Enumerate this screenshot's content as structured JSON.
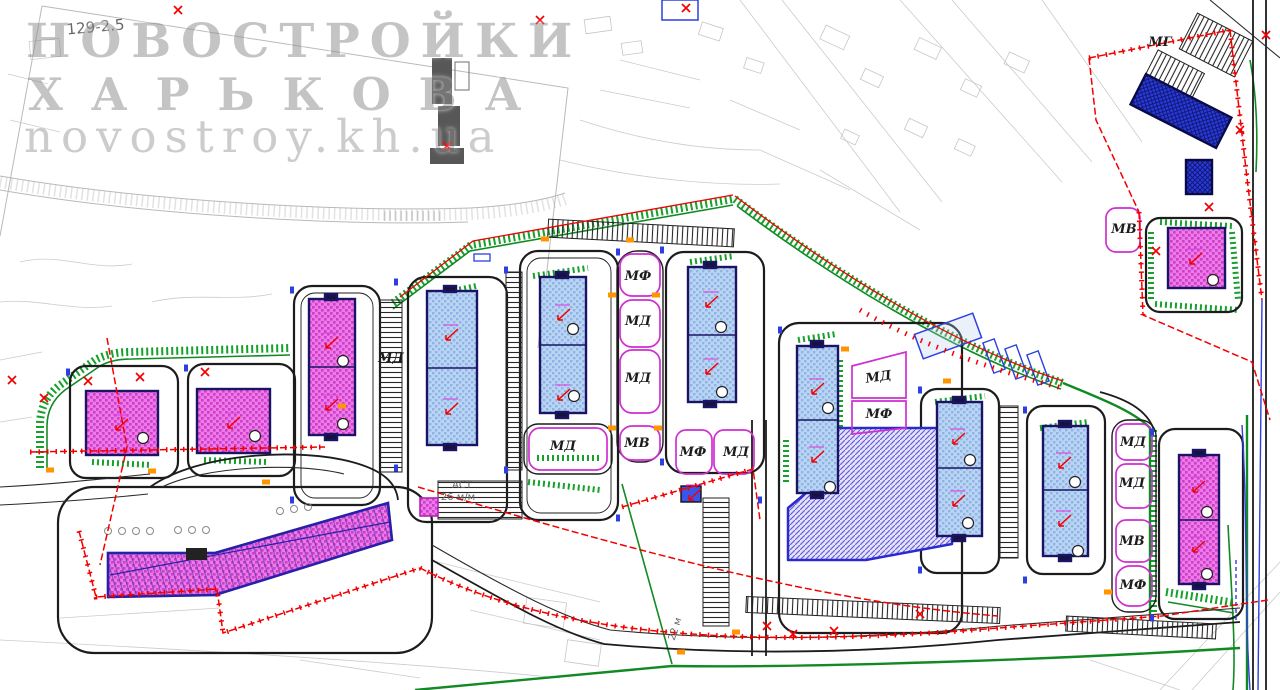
{
  "watermark": {
    "line1": "НОВОСТРОЙКИ",
    "line2": "ХАРЬКОВА",
    "line3": "novostroy.kh.ua"
  },
  "plan": {
    "zone_labels": [
      {
        "text": "МФ",
        "x": 638,
        "y": 280,
        "rotate": 0
      },
      {
        "text": "МД",
        "x": 638,
        "y": 325,
        "rotate": 0
      },
      {
        "text": "МД",
        "x": 638,
        "y": 382,
        "rotate": 0
      },
      {
        "text": "МВ",
        "x": 637,
        "y": 447,
        "rotate": 0
      },
      {
        "text": "МФ",
        "x": 693,
        "y": 456,
        "rotate": 0
      },
      {
        "text": "МД",
        "x": 736,
        "y": 456,
        "rotate": 0
      },
      {
        "text": "МД",
        "x": 391,
        "y": 362,
        "rotate": 0
      },
      {
        "text": "МД",
        "x": 563,
        "y": 450,
        "rotate": 0
      },
      {
        "text": "МД",
        "x": 879,
        "y": 381,
        "rotate": -8
      },
      {
        "text": "МФ",
        "x": 879,
        "y": 418,
        "rotate": 0
      },
      {
        "text": "МД",
        "x": 1133,
        "y": 446,
        "rotate": 0
      },
      {
        "text": "МД",
        "x": 1132,
        "y": 487,
        "rotate": 0
      },
      {
        "text": "МВ",
        "x": 1132,
        "y": 545,
        "rotate": 0
      },
      {
        "text": "МФ",
        "x": 1133,
        "y": 589,
        "rotate": 0
      },
      {
        "text": "МВ",
        "x": 1124,
        "y": 233,
        "rotate": 0
      },
      {
        "text": "МГ",
        "x": 1160,
        "y": 46,
        "rotate": 0
      }
    ],
    "notes": [
      {
        "text": "129-2.5",
        "x": 96,
        "y": 32,
        "rotate": -5,
        "size": 15
      },
      {
        "text": "АСТ",
        "x": 462,
        "y": 488,
        "rotate": 0,
        "size": 10
      },
      {
        "text": "26 м/м",
        "x": 458,
        "y": 500,
        "rotate": 0,
        "size": 10
      },
      {
        "text": "22 м",
        "x": 678,
        "y": 630,
        "rotate": -72,
        "size": 10
      }
    ]
  },
  "colors": {
    "magenta_building_fill": "#ec7ae8",
    "magenta_building_hatch": "#c437be",
    "blue_building_fill": "#b9d3f2",
    "blue_building_hatch": "#86abdc",
    "dark_blue_building": "#2a3ad8",
    "underground_zone_hatch": "#7c58d6",
    "green_landscape": "#17a02c",
    "red_boundary": "#f20000",
    "orange_marker": "#ff9500",
    "magenta_parcel_outline": "#cf2fd0",
    "road_black": "#1c1c1c",
    "topo_gray": "#c2c2c2",
    "watermark_gray": "#8f8f8f"
  }
}
